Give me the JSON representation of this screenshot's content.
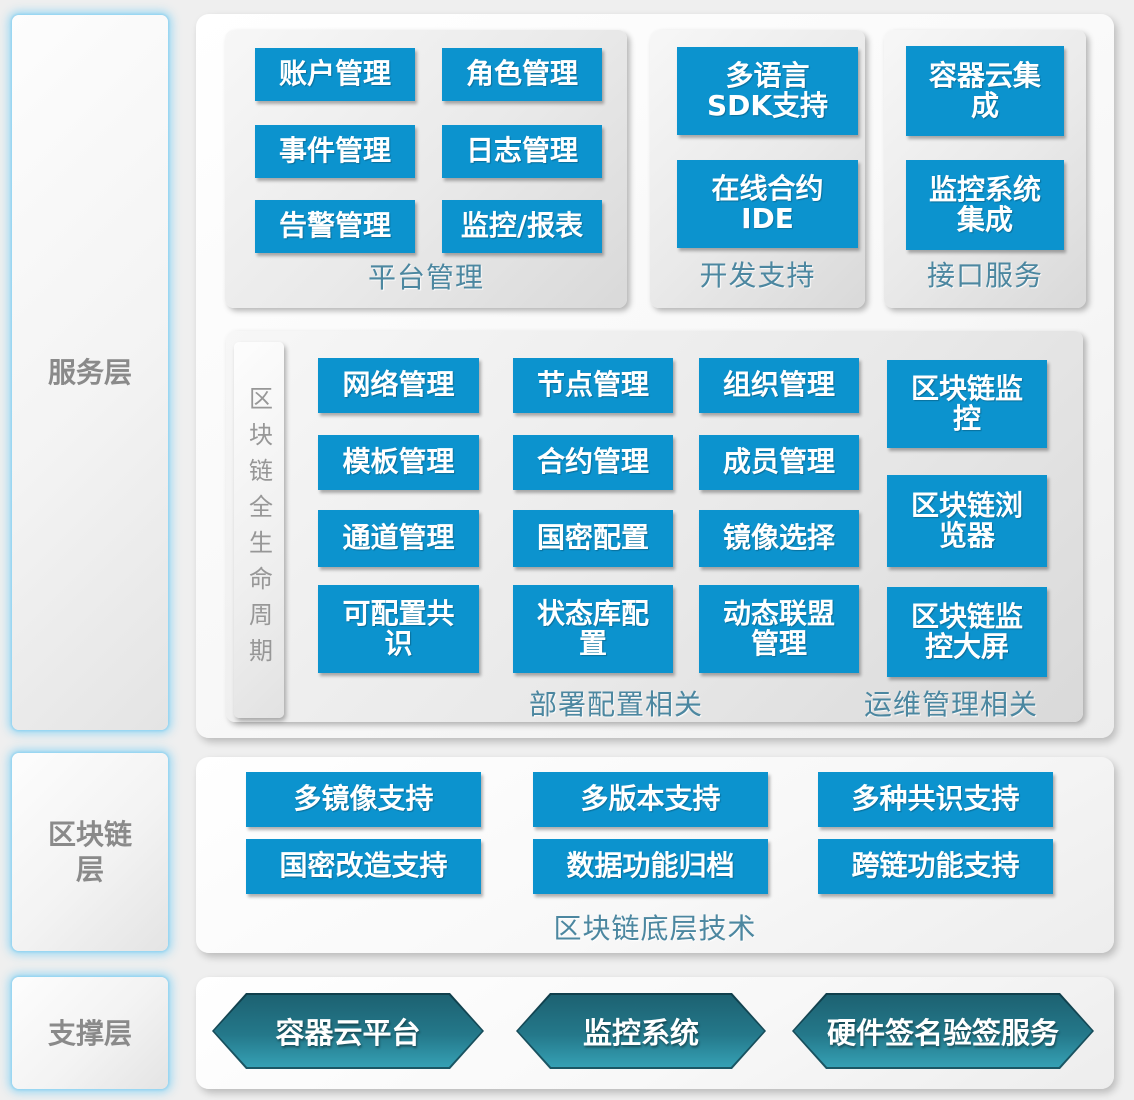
{
  "colors": {
    "accent_blue": "#0c93ce",
    "teal_label": "#4c87a0",
    "hex_dark": "#1d6272",
    "hex_light": "#35a0b4"
  },
  "sidebar": {
    "service_layer": "服务层",
    "blockchain_layer": "区块链\n层",
    "support_layer": "支撑层"
  },
  "service_layer": {
    "platform_panel": {
      "label": "平台管理",
      "boxes": [
        "账户管理",
        "角色管理",
        "事件管理",
        "日志管理",
        "告警管理",
        "监控/报表"
      ]
    },
    "dev_panel": {
      "label": "开发支持",
      "boxes": [
        "多语言\nSDK支持",
        "在线合约\nIDE"
      ]
    },
    "api_panel": {
      "label": "接口服务",
      "boxes": [
        "容器云集\n成",
        "监控系统\n集成"
      ]
    },
    "lifecycle_panel": {
      "strip_label": "区块链全生命周期",
      "columns": [
        [
          "网络管理",
          "模板管理",
          "通道管理",
          "可配置共\n识"
        ],
        [
          "节点管理",
          "合约管理",
          "国密配置",
          "状态库配\n置"
        ],
        [
          "组织管理",
          "成员管理",
          "镜像选择",
          "动态联盟\n管理"
        ],
        [
          "区块链监\n控",
          "区块链浏\n览器",
          "区块链监\n控大屏"
        ]
      ],
      "deploy_label": "部署配置相关",
      "ops_label": "运维管理相关"
    }
  },
  "blockchain_layer": {
    "boxes": [
      "多镜像支持",
      "多版本支持",
      "多种共识支持",
      "国密改造支持",
      "数据功能归档",
      "跨链功能支持"
    ],
    "label": "区块链底层技术"
  },
  "support_layer": {
    "hexagons": [
      "容器云平台",
      "监控系统",
      "硬件签名验签服务"
    ]
  }
}
